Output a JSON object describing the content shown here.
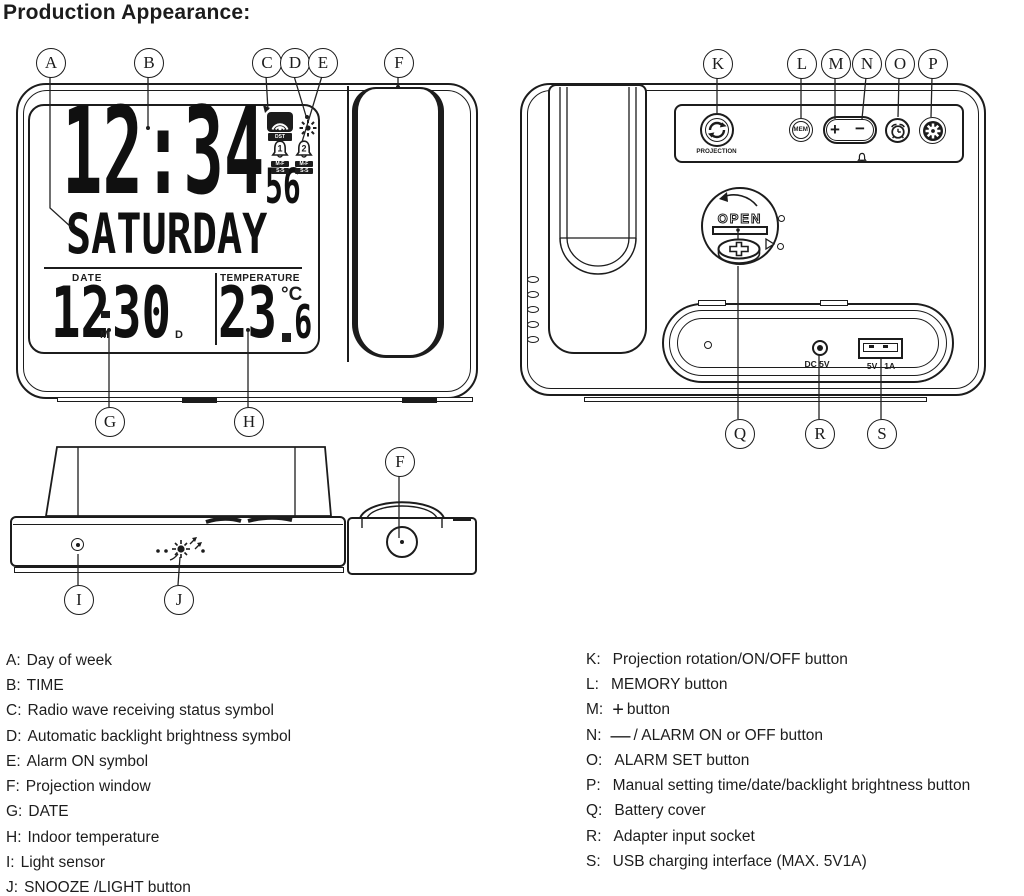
{
  "title": "Production Appearance:",
  "colors": {
    "ink": "#1c1c1c",
    "bg": "#ffffff"
  },
  "front_view": {
    "callouts_top": [
      "A",
      "B",
      "C",
      "D",
      "E",
      "F"
    ],
    "callouts_bottom": [
      "G",
      "H"
    ],
    "lcd": {
      "time": "12:34",
      "seconds": "56",
      "day": "SATURDAY",
      "date_label": "DATE",
      "date_month": "12",
      "date_day": "30",
      "month_mark": "M",
      "day_mark": "D",
      "temp_label": "TEMPERATURE",
      "temp_int": "23",
      "temp_frac": "6",
      "temp_unit": "°C",
      "dst_badge": "DST",
      "alarm1_num": "1",
      "alarm2_num": "2",
      "badge_weekday": "M-F",
      "badge_weekend": "S-S"
    }
  },
  "back_view": {
    "callouts_top": [
      "K",
      "L",
      "M",
      "N",
      "O",
      "P"
    ],
    "callouts_bottom": [
      "Q",
      "R",
      "S"
    ],
    "labels": {
      "projection": "PROJECTION",
      "mem": "MEM",
      "plus": "+",
      "minus": "−",
      "open": "OPEN",
      "dc": "DC 5V",
      "usb_v": "5V",
      "usb_a": "1A"
    }
  },
  "top_view": {
    "callouts": [
      "F",
      "I",
      "J"
    ]
  },
  "icons": {
    "radio_wave": "broadcast-dome",
    "auto_backlight": "sun",
    "alarm": "bell",
    "projection_rotation": "circular-arrows",
    "alarm_set": "alarm-clock",
    "settings": "gear",
    "snooze": "press-burst",
    "light_sensor": "dot-circle",
    "battery": "coin-cell-plus",
    "projection_lens": "circle"
  },
  "legend": {
    "left": [
      {
        "key": "A:",
        "text": "Day of week"
      },
      {
        "key": "B:",
        "text": "TIME"
      },
      {
        "key": "C:",
        "text": "Radio wave receiving status symbol"
      },
      {
        "key": "D:",
        "text": "Automatic backlight brightness symbol"
      },
      {
        "key": "E:",
        "text": "Alarm ON symbol"
      },
      {
        "key": "F:",
        "text": "Projection window"
      },
      {
        "key": "G:",
        "text": "DATE"
      },
      {
        "key": "H:",
        "text": "Indoor temperature"
      },
      {
        "key": "I:",
        "text": "Light sensor"
      },
      {
        "key": "J:",
        "text": "SNOOZE /LIGHT button"
      }
    ],
    "right": [
      {
        "key": "K:",
        "glyph": "",
        "text": "Projection rotation/ON/OFF button"
      },
      {
        "key": "L:",
        "glyph": "",
        "text": "MEMORY button"
      },
      {
        "key": "M:",
        "glyph": "+",
        "text": "button"
      },
      {
        "key": "N:",
        "glyph": "—",
        "text": "/ ALARM ON or OFF button"
      },
      {
        "key": "O:",
        "glyph": "",
        "text": "ALARM SET button"
      },
      {
        "key": "P:",
        "glyph": "",
        "text": "Manual setting time/date/backlight brightness button"
      },
      {
        "key": "Q:",
        "glyph": "",
        "text": "Battery cover"
      },
      {
        "key": "R:",
        "glyph": "",
        "text": "Adapter input socket"
      },
      {
        "key": "S:",
        "glyph": "",
        "text": "USB charging interface (MAX. 5V1A)"
      }
    ]
  }
}
